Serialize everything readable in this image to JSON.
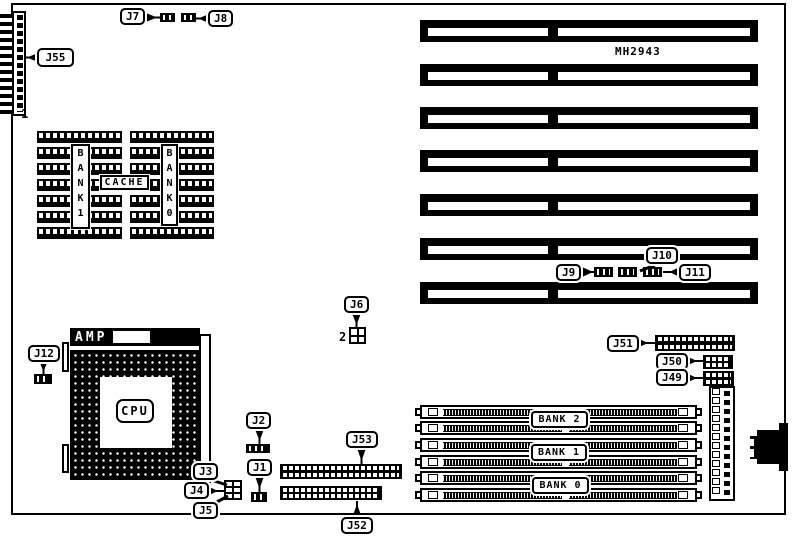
{
  "board": {
    "model": "MH2943"
  },
  "colors": {
    "ink": "#000000",
    "paper": "#ffffff"
  },
  "callouts": {
    "j1": "J1",
    "j2": "J2",
    "j3": "J3",
    "j4": "J4",
    "j5": "J5",
    "j6": "J6",
    "j7": "J7",
    "j8": "J8",
    "j9": "J9",
    "j10": "J10",
    "j11": "J11",
    "j12": "J12",
    "j49": "J49",
    "j50": "J50",
    "j51": "J51",
    "j52": "J52",
    "j53": "J53",
    "j55": "J55"
  },
  "annotations": {
    "edge_pin1": "1",
    "j6_pin2": "2"
  },
  "cpu": {
    "brand": "AMP",
    "label": "CPU"
  },
  "cache": {
    "label": "CACHE",
    "bank1": "BANK 1",
    "bank0": "BANK 0"
  },
  "memory": {
    "bank2": "BANK 2",
    "bank1": "BANK 1",
    "bank0": "BANK 0"
  },
  "counts": {
    "isa_slots": 7,
    "simm_slots": 6,
    "dip_groups": 2,
    "dip_rows_per_group": 7,
    "power_connector_pins": 12
  }
}
